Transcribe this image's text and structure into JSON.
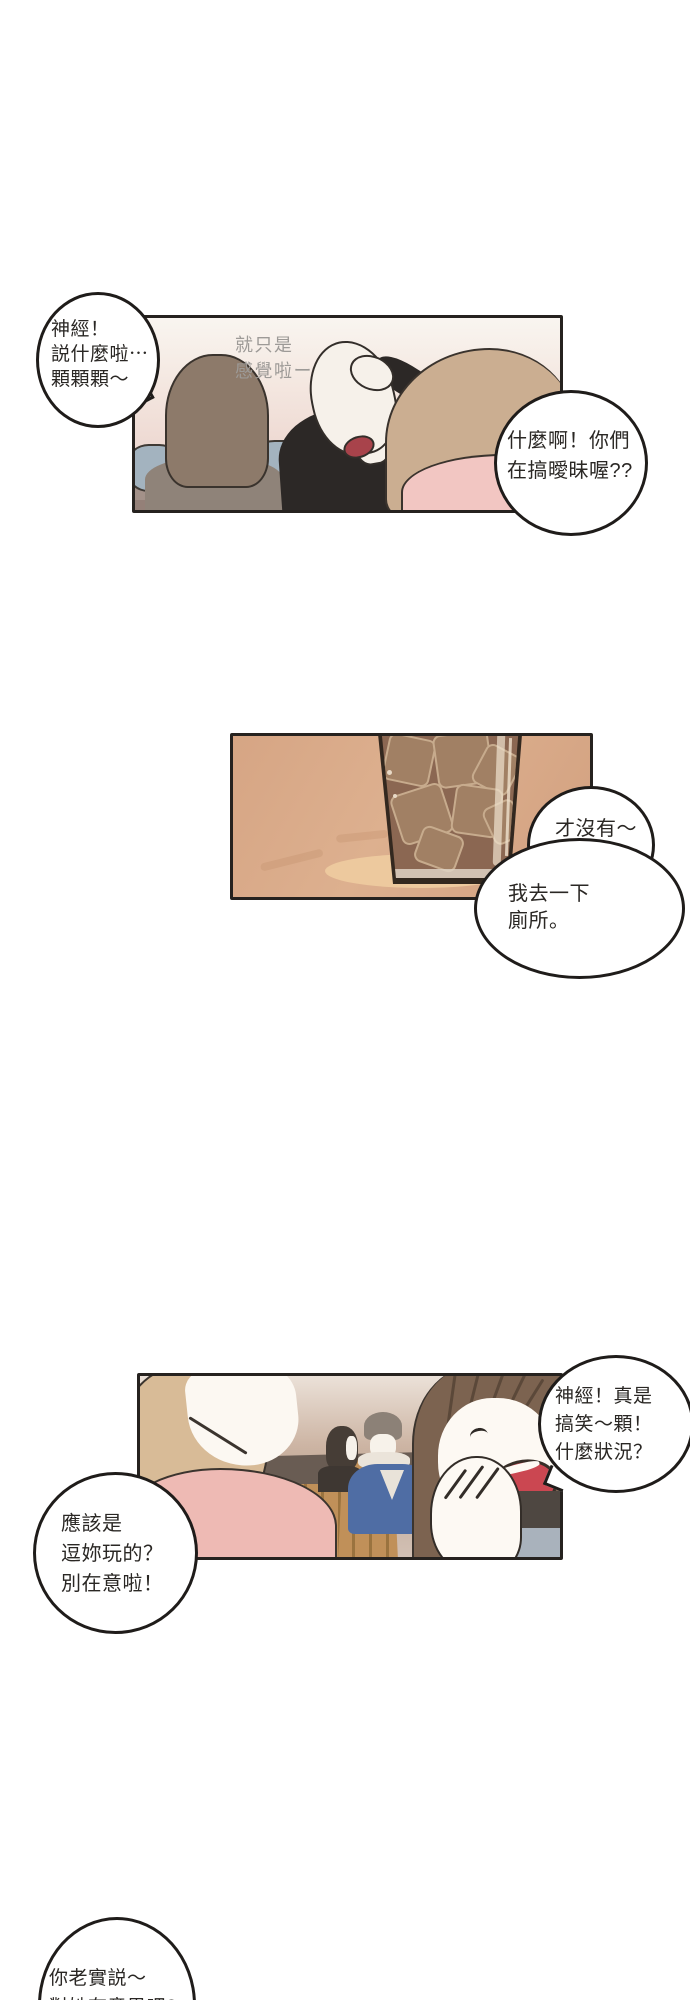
{
  "comic": {
    "panel1": {
      "caption": {
        "lines": [
          "就只是",
          "感覺啦ー"
        ]
      }
    },
    "bubbles": {
      "b1": {
        "lines": [
          "神經！",
          "説什麼啦⋯",
          "顆顆顆～"
        ]
      },
      "b2": {
        "lines": [
          "什麼啊！你們",
          "在搞曖昧喔??"
        ]
      },
      "b3": {
        "lines": [
          "才沒有～",
          "顆顆顆！"
        ]
      },
      "b4": {
        "lines": [
          "我去一下",
          "廁所。"
        ]
      },
      "b5": {
        "lines": [
          "神經！真是",
          "搞笑～顆！",
          "什麼狀況？"
        ]
      },
      "b6": {
        "lines": [
          "應該是",
          "逗妳玩的？",
          "別在意啦！"
        ]
      },
      "b7": {
        "lines": [
          "你老實説～",
          "對她有意思吧?"
        ]
      }
    },
    "colors": {
      "page_bg": "#ffffff",
      "panel_border": "#26221f",
      "bubble_border": "#1f1c1a",
      "caption_gray": "#9d9a97",
      "panel1_bg_top": "#f9f5f0",
      "panel1_bg_bottom": "#ead4cd",
      "couch": "#a39189",
      "panel2_bg": "#dcae8d",
      "drink_liquid": "#8b6752",
      "ice_cube": "#a18064",
      "panel3_wall": "#695c53",
      "denim_jacket": "#4f6da4",
      "pink_top": "#eebab4",
      "laugh_mouth": "#cb4751"
    }
  }
}
